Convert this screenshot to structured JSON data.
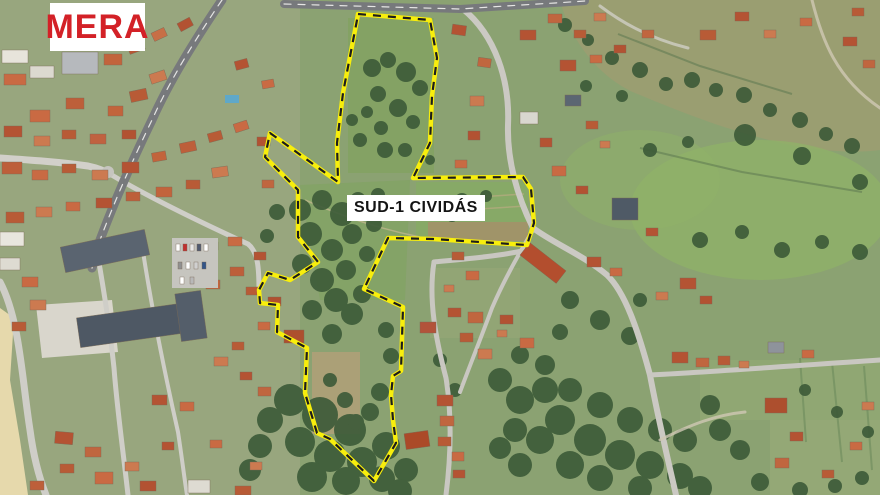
{
  "labels": {
    "area_tag": "MERA",
    "zone_name": "SUD-1 CIVIDÁS"
  },
  "colors": {
    "area_tag_text": "#d32127",
    "area_tag_bg": "#ffffff",
    "zone_name_text": "#141414",
    "zone_name_bg": "#ffffff",
    "boundary_yellow": "#f8ee0c",
    "boundary_dash": "#1c1c1c"
  },
  "boundary": {
    "name": "SUD-1 CIVIDÁS",
    "points": [
      [
        358,
        14
      ],
      [
        430,
        20
      ],
      [
        437,
        58
      ],
      [
        432,
        96
      ],
      [
        430,
        143
      ],
      [
        413,
        178
      ],
      [
        523,
        177
      ],
      [
        531,
        189
      ],
      [
        534,
        223
      ],
      [
        527,
        245
      ],
      [
        433,
        239
      ],
      [
        388,
        238
      ],
      [
        364,
        289
      ],
      [
        403,
        307
      ],
      [
        401,
        371
      ],
      [
        393,
        376
      ],
      [
        391,
        395
      ],
      [
        393,
        420
      ],
      [
        396,
        443
      ],
      [
        374,
        481
      ],
      [
        330,
        439
      ],
      [
        317,
        433
      ],
      [
        305,
        393
      ],
      [
        307,
        348
      ],
      [
        277,
        332
      ],
      [
        278,
        305
      ],
      [
        260,
        303
      ],
      [
        259,
        290
      ],
      [
        268,
        273
      ],
      [
        290,
        280
      ],
      [
        318,
        262
      ],
      [
        298,
        237
      ],
      [
        298,
        190
      ],
      [
        265,
        157
      ],
      [
        270,
        133
      ],
      [
        338,
        182
      ],
      [
        337,
        143
      ],
      [
        343,
        93
      ],
      [
        357,
        20
      ]
    ]
  }
}
